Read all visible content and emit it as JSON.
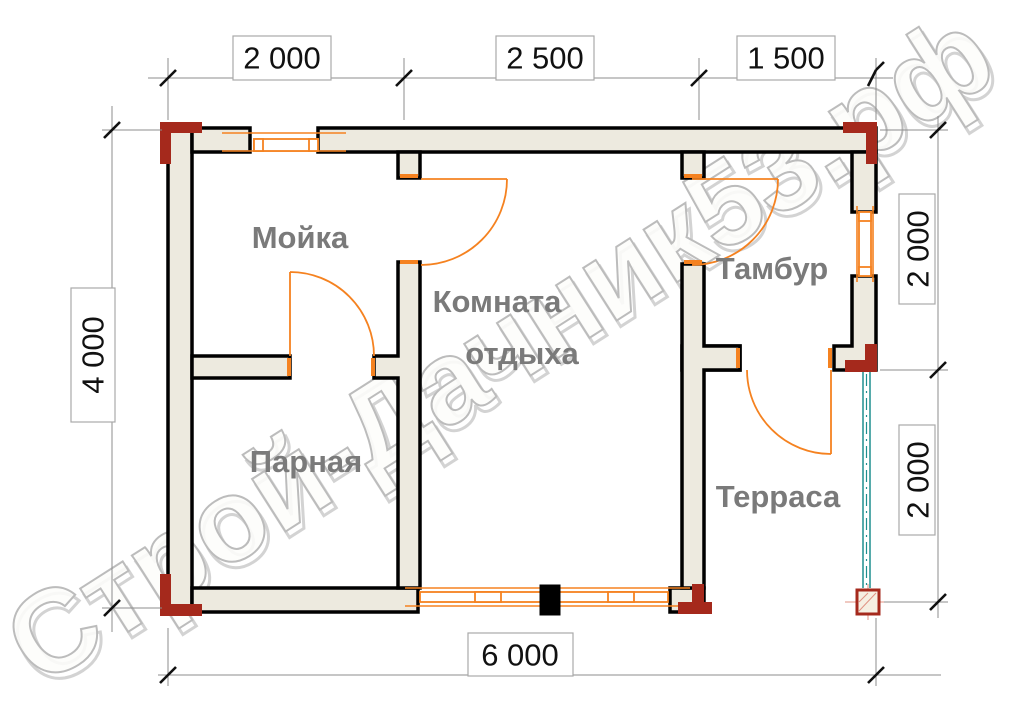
{
  "watermark": {
    "text": "Строй-Дачник53.рф"
  },
  "rooms": {
    "moyka": "Мойка",
    "parnaya": "Парная",
    "komnata_line1": "Комната",
    "komnata_line2": "отдыха",
    "tambur": "Тамбур",
    "terrasa": "Терраса"
  },
  "dimensions": {
    "top": [
      "2 000",
      "2 500",
      "1 500"
    ],
    "left": "4 000",
    "right": [
      "2 000",
      "2 000"
    ],
    "bottom": "6 000"
  },
  "colors": {
    "wall_fill": "#edeadf",
    "wall_outline": "#000000",
    "door_window": "#f58220",
    "terrace_edge": "#1f8f8f",
    "corner_marker": "#a5291c",
    "room_label": "#7a7a7a",
    "dimension_line": "#8c8c8c"
  }
}
